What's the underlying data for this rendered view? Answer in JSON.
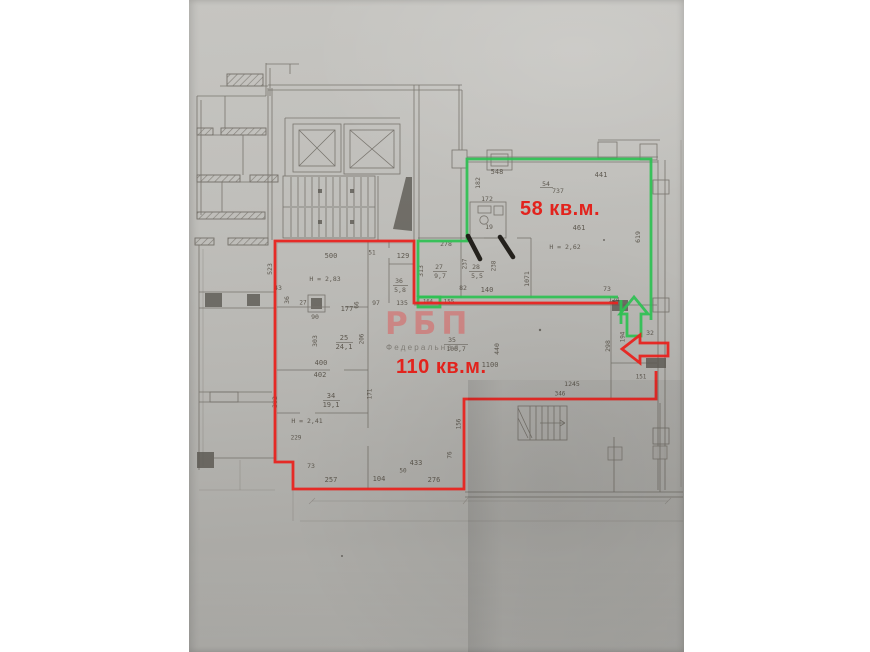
{
  "annotations": {
    "green_area_label": "58 кв.м.",
    "red_area_label": "110 кв.м.",
    "watermark": "РБП",
    "watermark_sub": "Федеральная"
  },
  "colors": {
    "green_outline": "#2ec153",
    "red_outline": "#e8231f",
    "label_red": "#e2231d",
    "watermark_pink": "#e05656",
    "paper_gray": "#bcbbb7",
    "pencil": "#5d5850"
  },
  "plan_numbers": [
    {
      "t": "548",
      "x": 497,
      "y": 172
    },
    {
      "t": "441",
      "x": 601,
      "y": 175
    },
    {
      "t": "54",
      "x": 546,
      "y": 184,
      "s": 6.5
    },
    {
      "t": "737",
      "x": 558,
      "y": 191,
      "s": 6.5
    },
    {
      "t": "182",
      "x": 478,
      "y": 183,
      "r": 1,
      "s": 6.5
    },
    {
      "t": "172",
      "x": 487,
      "y": 199,
      "s": 6.5
    },
    {
      "t": "19",
      "x": 489,
      "y": 227,
      "s": 6.5
    },
    {
      "t": "461",
      "x": 579,
      "y": 228
    },
    {
      "t": "H = 2,62",
      "x": 565,
      "y": 247,
      "s": 6.5
    },
    {
      "t": "619",
      "x": 638,
      "y": 237,
      "r": 1,
      "s": 6.5
    },
    {
      "t": "1071",
      "x": 527,
      "y": 279,
      "r": 1,
      "s": 6.5
    },
    {
      "t": "140",
      "x": 487,
      "y": 290
    },
    {
      "t": "73",
      "x": 607,
      "y": 289,
      "s": 6.5
    },
    {
      "t": "124",
      "x": 614,
      "y": 300,
      "s": 6
    },
    {
      "t": "278",
      "x": 446,
      "y": 244,
      "s": 6.5
    },
    {
      "t": "313",
      "x": 421,
      "y": 271,
      "r": 1,
      "s": 6.5
    },
    {
      "t": "27",
      "x": 439,
      "y": 267,
      "s": 6.5
    },
    {
      "t": "9,7",
      "x": 440,
      "y": 276,
      "s": 6.5
    },
    {
      "t": "237",
      "x": 465,
      "y": 264,
      "r": 1,
      "s": 6
    },
    {
      "t": "28",
      "x": 476,
      "y": 267,
      "s": 6.5
    },
    {
      "t": "5,5",
      "x": 477,
      "y": 276,
      "s": 6.5
    },
    {
      "t": "238",
      "x": 494,
      "y": 266,
      "r": 1,
      "s": 6
    },
    {
      "t": "82",
      "x": 463,
      "y": 288,
      "s": 6.5
    },
    {
      "t": "164",
      "x": 428,
      "y": 302,
      "s": 5.5
    },
    {
      "t": "155",
      "x": 449,
      "y": 302,
      "s": 6
    },
    {
      "t": "500",
      "x": 331,
      "y": 256
    },
    {
      "t": "523",
      "x": 270,
      "y": 269,
      "r": 1,
      "s": 6.5
    },
    {
      "t": "51",
      "x": 372,
      "y": 253,
      "s": 6
    },
    {
      "t": "129",
      "x": 403,
      "y": 256
    },
    {
      "t": "H = 2,83",
      "x": 325,
      "y": 279,
      "s": 6.5
    },
    {
      "t": "43",
      "x": 278,
      "y": 288,
      "s": 6.5
    },
    {
      "t": "36",
      "x": 287,
      "y": 300,
      "r": 1,
      "s": 6.5
    },
    {
      "t": "27",
      "x": 303,
      "y": 303,
      "s": 6
    },
    {
      "t": "90",
      "x": 315,
      "y": 317,
      "s": 6.5
    },
    {
      "t": "177",
      "x": 347,
      "y": 309
    },
    {
      "t": "66",
      "x": 357,
      "y": 305,
      "r": 1,
      "s": 6
    },
    {
      "t": "97",
      "x": 376,
      "y": 303,
      "s": 6.5
    },
    {
      "t": "135",
      "x": 402,
      "y": 303,
      "s": 6.5
    },
    {
      "t": "36",
      "x": 399,
      "y": 281,
      "s": 6.5
    },
    {
      "t": "5,8",
      "x": 400,
      "y": 290,
      "s": 6.5
    },
    {
      "t": "303",
      "x": 315,
      "y": 341,
      "r": 1,
      "s": 6.5
    },
    {
      "t": "25",
      "x": 344,
      "y": 338
    },
    {
      "t": "24,1",
      "x": 344,
      "y": 347
    },
    {
      "t": "206",
      "x": 362,
      "y": 339,
      "r": 1,
      "s": 6
    },
    {
      "t": "400",
      "x": 321,
      "y": 363
    },
    {
      "t": "402",
      "x": 320,
      "y": 375
    },
    {
      "t": "34",
      "x": 331,
      "y": 396
    },
    {
      "t": "19,1",
      "x": 331,
      "y": 405
    },
    {
      "t": "382",
      "x": 275,
      "y": 402,
      "r": 1,
      "s": 6.5
    },
    {
      "t": "171",
      "x": 370,
      "y": 394,
      "r": 1,
      "s": 6
    },
    {
      "t": "H = 2,41",
      "x": 307,
      "y": 421,
      "s": 6.5
    },
    {
      "t": "229",
      "x": 296,
      "y": 438,
      "s": 6
    },
    {
      "t": "73",
      "x": 311,
      "y": 466,
      "s": 6.5
    },
    {
      "t": "257",
      "x": 331,
      "y": 480
    },
    {
      "t": "104",
      "x": 379,
      "y": 479
    },
    {
      "t": "50",
      "x": 403,
      "y": 471,
      "s": 6
    },
    {
      "t": "433",
      "x": 416,
      "y": 463
    },
    {
      "t": "276",
      "x": 434,
      "y": 480
    },
    {
      "t": "76",
      "x": 450,
      "y": 455,
      "r": 1,
      "s": 6
    },
    {
      "t": "156",
      "x": 459,
      "y": 424,
      "r": 1,
      "s": 6
    },
    {
      "t": "440",
      "x": 497,
      "y": 349,
      "r": 1,
      "s": 6.5
    },
    {
      "t": "1100",
      "x": 490,
      "y": 365
    },
    {
      "t": "35",
      "x": 452,
      "y": 340,
      "s": 6.5
    },
    {
      "t": "106,7",
      "x": 456,
      "y": 349,
      "s": 6.5
    },
    {
      "t": "1245",
      "x": 572,
      "y": 384,
      "s": 6.5
    },
    {
      "t": "346",
      "x": 560,
      "y": 394,
      "s": 6
    },
    {
      "t": "298",
      "x": 608,
      "y": 346,
      "r": 1,
      "s": 6.5
    },
    {
      "t": "194",
      "x": 623,
      "y": 337,
      "r": 1,
      "s": 6
    },
    {
      "t": "32",
      "x": 650,
      "y": 333,
      "s": 6.5
    },
    {
      "t": "151",
      "x": 641,
      "y": 377,
      "s": 6
    }
  ]
}
